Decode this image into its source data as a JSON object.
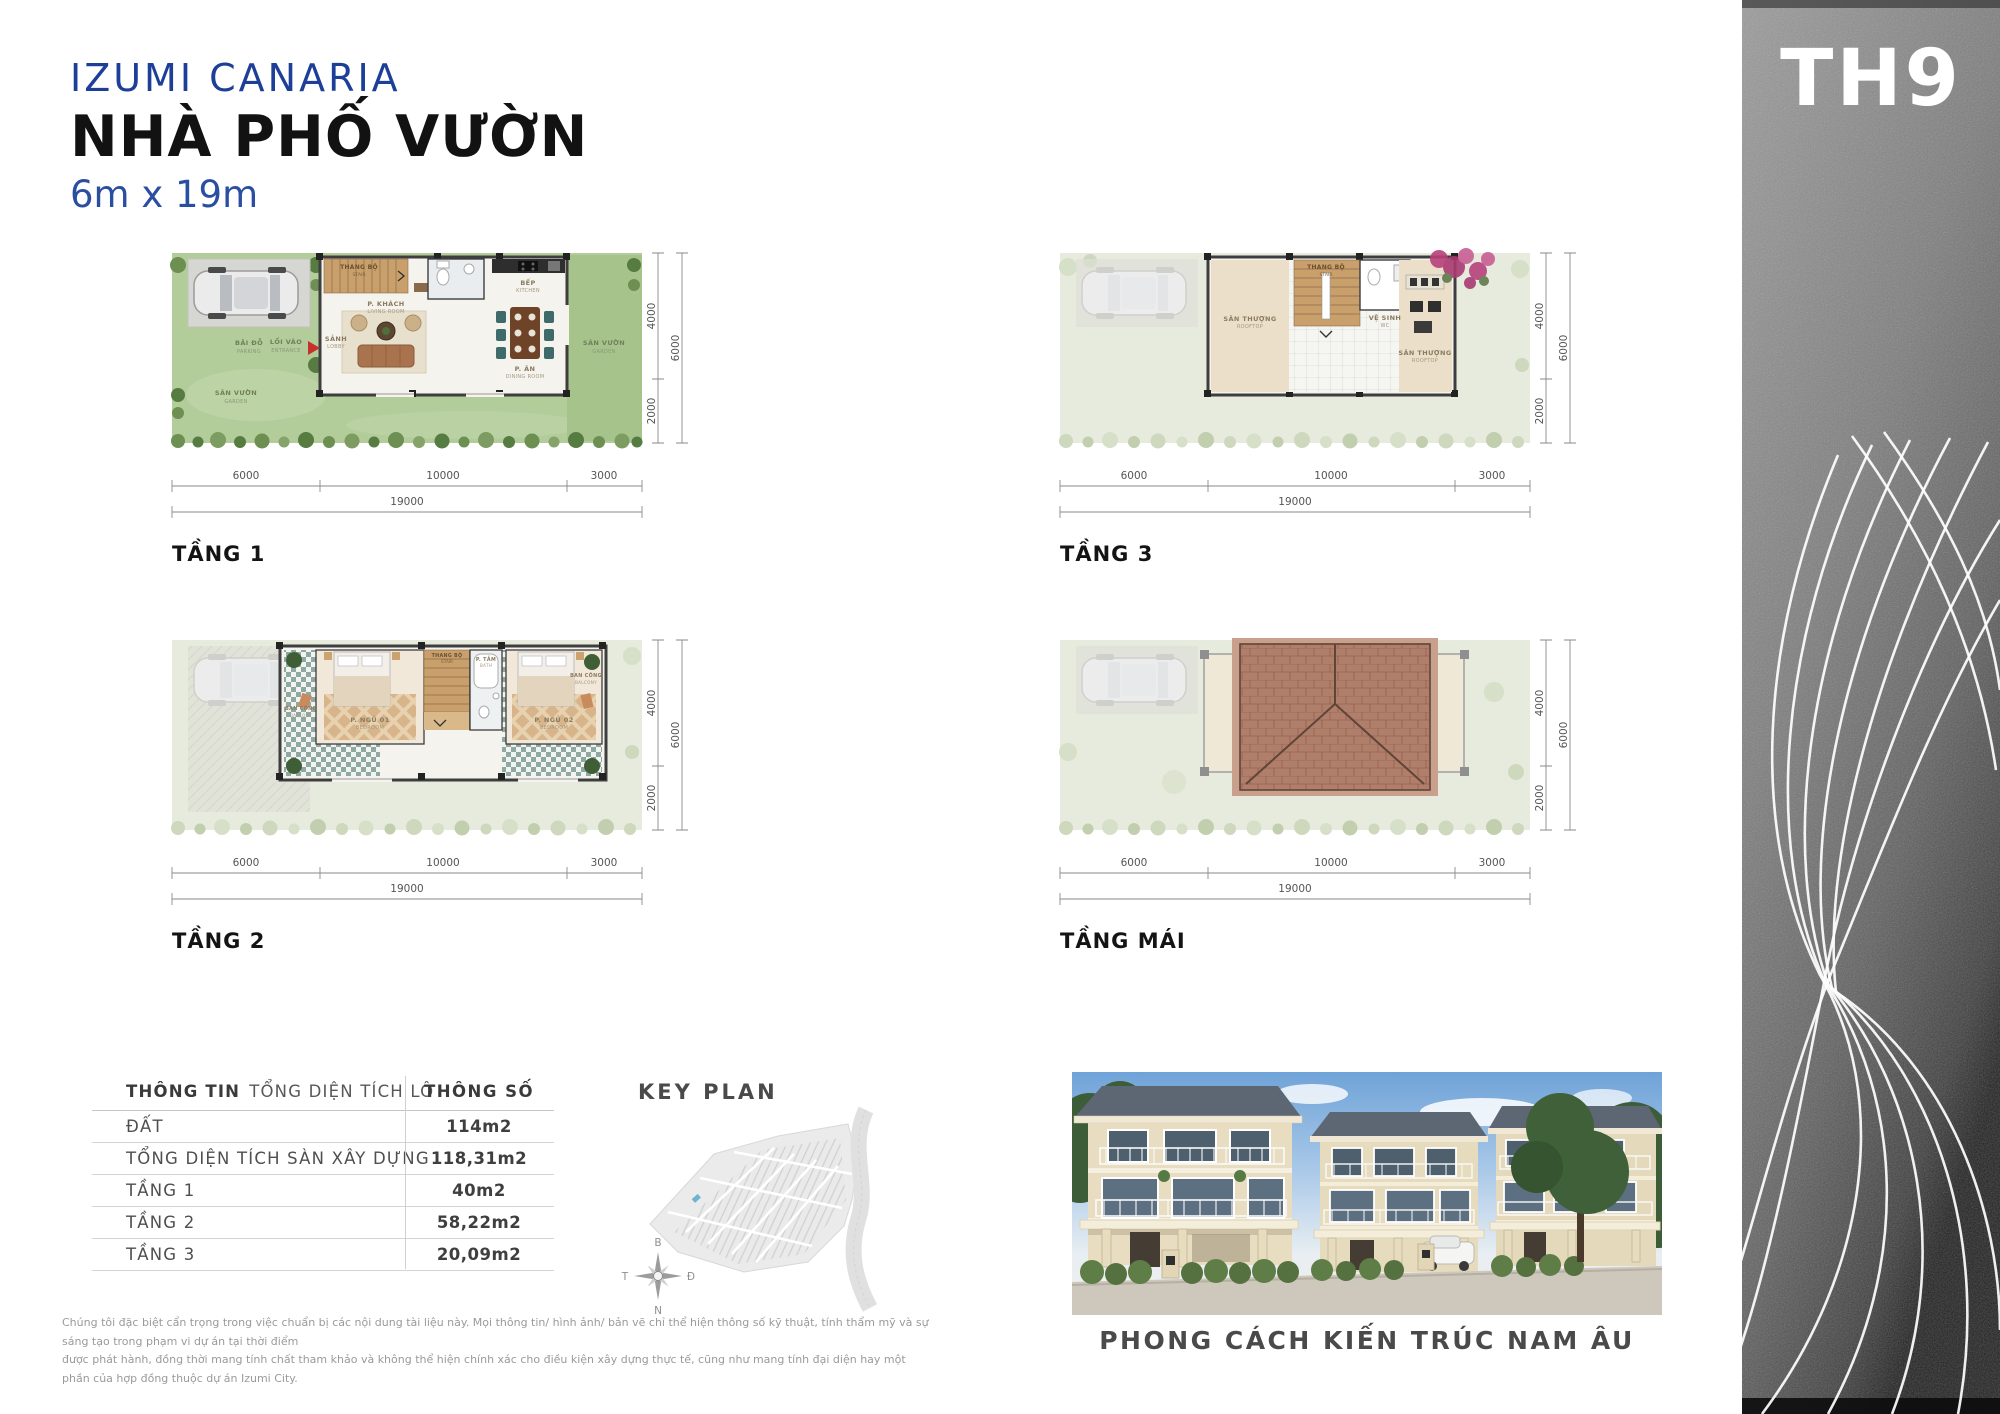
{
  "header": {
    "project": "IZUMI CANARIA",
    "title": "NHÀ PHỐ VƯỜN",
    "lot_size": "6m x 19m",
    "unit_code": "TH9"
  },
  "dims": {
    "a": "6000",
    "b": "10000",
    "c": "3000",
    "total": "19000",
    "v1": "4000",
    "v2": "2000",
    "vtotal": "6000"
  },
  "plans": {
    "t1": {
      "label": "TẦNG 1",
      "rooms": {
        "parking_vi": "BÃI ĐỖ",
        "parking_en": "PARKING",
        "garden_vi": "SÂN VƯỜN",
        "garden_en": "GARDEN",
        "entry_vi": "LỐI VÀO",
        "entry_en": "ENTRANCE",
        "lobby_vi": "SẢNH",
        "lobby_en": "LOBBY",
        "stair_vi": "THANG BỘ",
        "stair_en": "STAIR",
        "living_vi": "P. KHÁCH",
        "living_en": "LIVING ROOM",
        "kitchen_vi": "BẾP",
        "kitchen_en": "KITCHEN",
        "dining_vi": "P. ĂN",
        "dining_en": "DINING ROOM",
        "garden2_vi": "SÂN VƯỜN",
        "garden2_en": "GARDEN"
      }
    },
    "t2": {
      "label": "TẦNG 2",
      "rooms": {
        "balcony1_vi": "BAN CÔNG",
        "balcony1_en": "BALCONY",
        "bed1_vi": "P. NGỦ 01",
        "bed1_en": "BEDROOM",
        "stair_vi": "THANG BỘ",
        "stair_en": "STAIR",
        "bath_vi": "P. TẮM",
        "bath_en": "BATH",
        "bed2_vi": "P. NGỦ 02",
        "bed2_en": "BEDROOM",
        "balcony2_vi": "BAN CÔNG",
        "balcony2_en": "BALCONY"
      }
    },
    "t3": {
      "label": "TẦNG 3",
      "rooms": {
        "roof1_vi": "SÂN THƯỢNG",
        "roof1_en": "ROOFTOP",
        "stair_vi": "THANG BỘ",
        "stair_en": "STAIR",
        "wc_vi": "VỆ SINH",
        "wc_en": "WC",
        "roof2_vi": "SÂN THƯỢNG",
        "roof2_en": "ROOFTOP"
      }
    },
    "mai": {
      "label": "TẦNG MÁI"
    }
  },
  "table": {
    "header_left_bold": "THÔNG TIN",
    "header_left_rest": "TỔNG DIỆN TÍCH LÔ",
    "header_right": "THÔNG SỐ",
    "rows": [
      {
        "label": "ĐẤT",
        "value": "114m2"
      },
      {
        "label": "TỔNG DIỆN TÍCH SÀN XÂY DỰNG",
        "value": "118,31m2"
      },
      {
        "label": "TẦNG 1",
        "value": "40m2"
      },
      {
        "label": "TẦNG 2",
        "value": "58,22m2"
      },
      {
        "label": "TẦNG 3",
        "value": "20,09m2"
      }
    ]
  },
  "key_plan": {
    "title": "KEY PLAN",
    "compass": {
      "north": "B",
      "south": "N",
      "west": "T",
      "east": "Đ"
    }
  },
  "photo": {
    "caption": "PHONG CÁCH KIẾN TRÚC NAM ÂU"
  },
  "disclaimer": {
    "line1": "Chúng tôi đặc biệt cẩn trọng trong việc chuẩn bị các nội dung tài liệu này. Mọi thông tin/ hình ảnh/ bản vẽ chỉ thể hiện thông số kỹ thuật, tính thẩm mỹ và sự sáng tạo trong phạm vi dự án tại thời điểm",
    "line2": "được phát hành, đồng thời mang tính chất tham khảo và không thể hiện chính xác cho điều kiện xây dựng thực tế, cũng như mang tính đại diện hay một phần của hợp đồng thuộc dự án Izumi City."
  },
  "colors": {
    "brand_blue": "#1d3f97",
    "text_dark": "#121212",
    "text_gray": "#4f4f4f",
    "grass": "#b2cc9a",
    "roof": "#b07f6b",
    "accent_red": "#c8312b"
  }
}
